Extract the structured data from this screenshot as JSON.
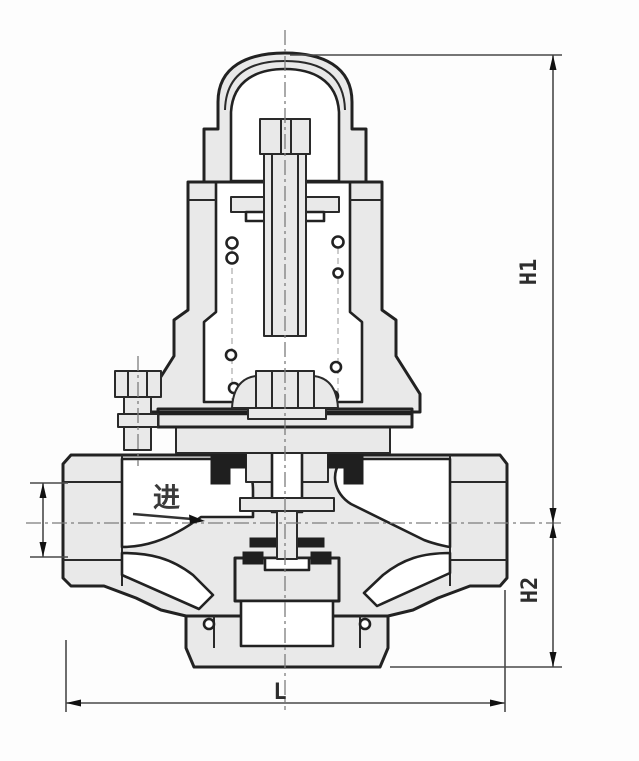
{
  "figure": {
    "kind": "technical-drawing",
    "subject": "pressure reducing valve cross-section",
    "labels": {
      "dim_h1": "H1",
      "dim_h2": "H2",
      "dim_l": "L",
      "inlet": "进"
    },
    "colors": {
      "background": "#fdfdfd",
      "outline": "#222222",
      "metal_fill": "#e9e9e9",
      "cavity_fill": "#ffffff",
      "seal_fill": "#1f1f1f",
      "dimension_line": "#4a4a4a",
      "centerline": "#7d7d7d"
    }
  }
}
